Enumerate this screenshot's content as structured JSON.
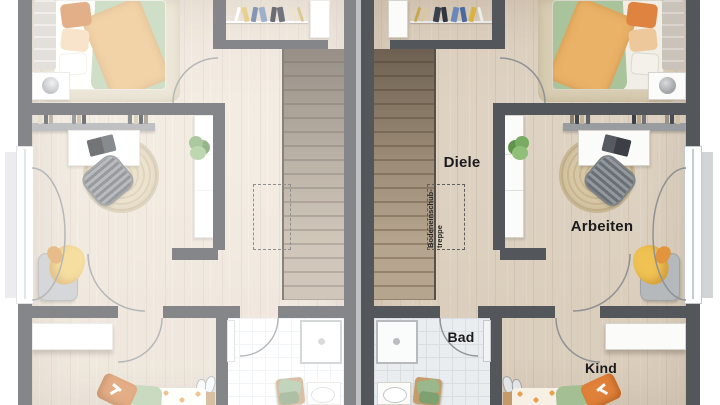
{
  "floorplan": {
    "rooms": {
      "diele": "Diele",
      "arbeiten": "Arbeiten",
      "bad": "Bad",
      "kind": "Kind"
    },
    "attic_hatch": {
      "line1": "Bodeneinschub-",
      "line2": "treppe"
    },
    "colors": {
      "wall": "#53565b",
      "wood_floor": "#ded3c3",
      "tile_floor": "#eaedef",
      "stair_wood": "#a6927c",
      "accent_orange": "#e0813a",
      "accent_green": "#a9c49c",
      "label_text": "#1b1b1d"
    }
  }
}
